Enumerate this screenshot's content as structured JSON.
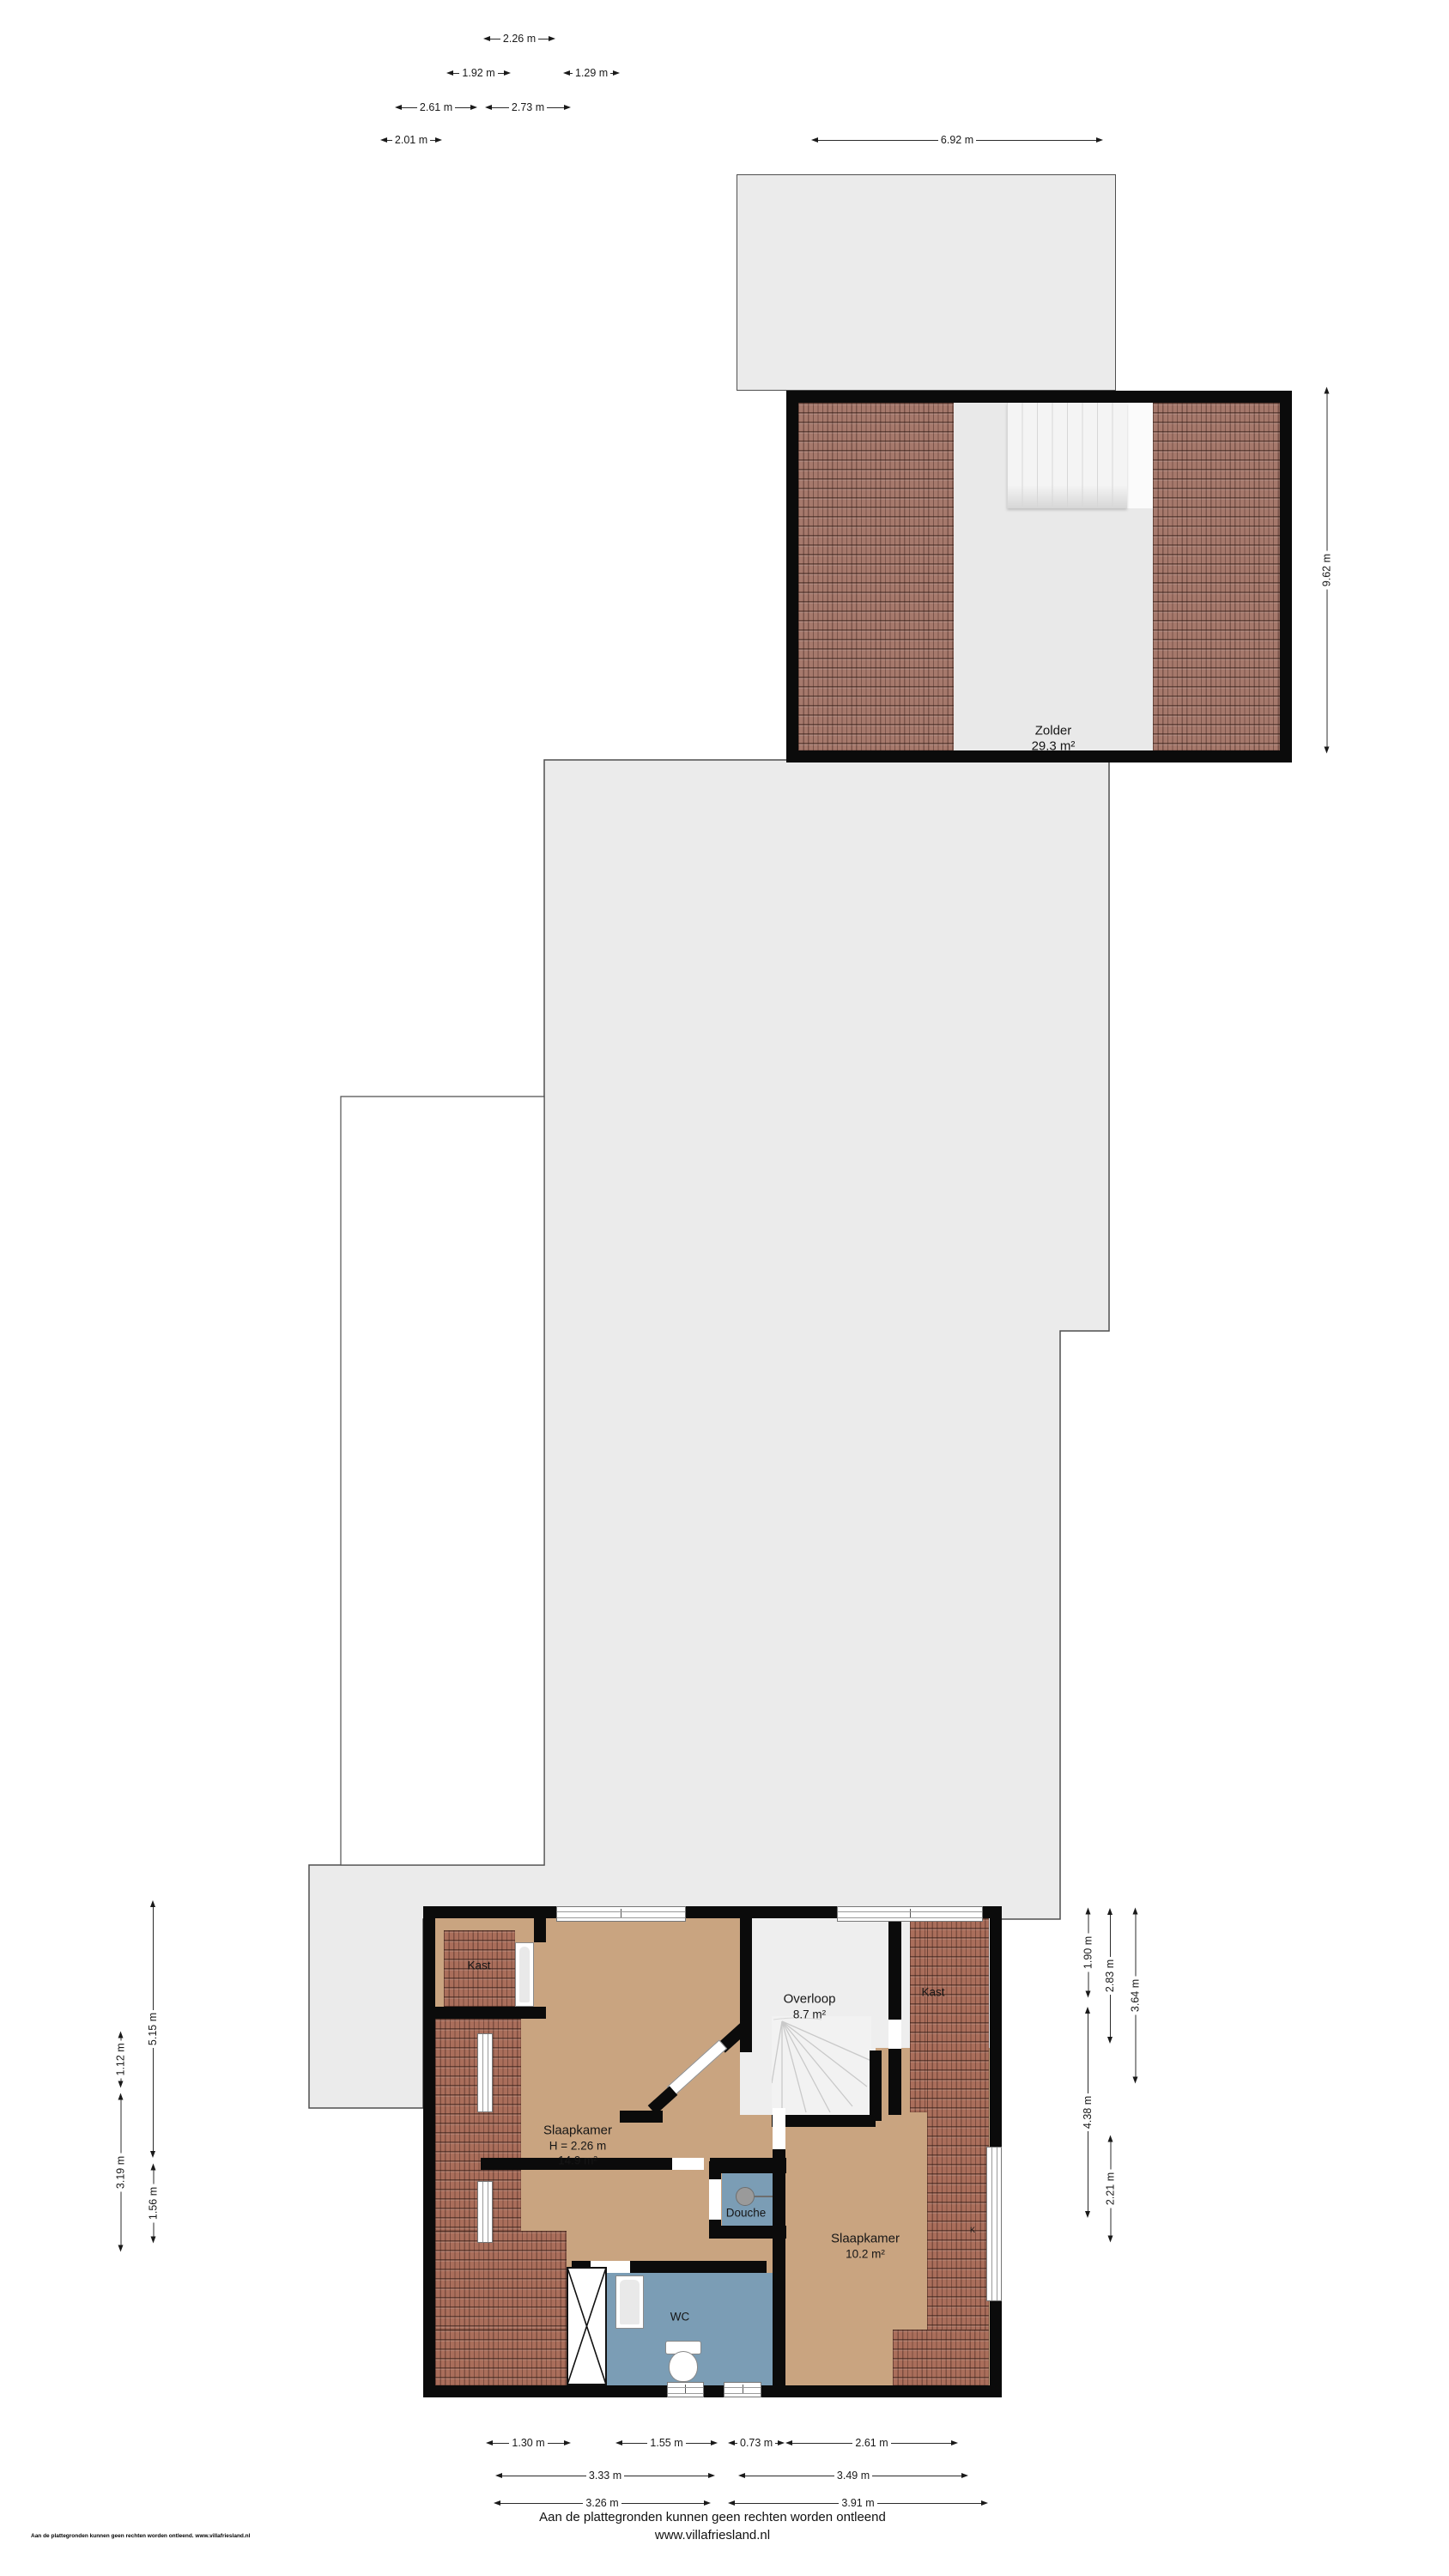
{
  "rooms": {
    "attic": {
      "name": "Zolder",
      "area": "29.3 m²"
    },
    "landing": {
      "name": "Overloop",
      "area": "8.7 m²"
    },
    "bedroom_left": {
      "name": "Slaapkamer",
      "height": "H = 2.26 m",
      "area": "14.9 m²"
    },
    "bedroom_right": {
      "name": "Slaapkamer",
      "area": "10.2 m²"
    },
    "shower": {
      "name": "Douche"
    },
    "wc": {
      "name": "WC"
    },
    "closet_left": {
      "label": "Kast"
    },
    "closet_right": {
      "label": "Kast"
    },
    "closet_abbr": {
      "label": "K"
    }
  },
  "dimensions": {
    "top": [
      "2.26 m",
      "1.92 m",
      "1.29 m",
      "2.61 m",
      "2.73 m",
      "2.01 m",
      "6.92 m"
    ],
    "attic_side": "9.62 m",
    "left": [
      "5.15 m",
      "1.12 m",
      "3.19 m",
      "1.56 m"
    ],
    "right": [
      "1.90 m",
      "2.83 m",
      "3.64 m",
      "4.38 m",
      "2.21 m"
    ],
    "bottom": [
      "1.30 m",
      "1.55 m",
      "0.73 m",
      "2.61 m",
      "3.33 m",
      "3.49 m",
      "3.26 m",
      "3.91 m"
    ]
  },
  "footer": {
    "disclaimer": "Aan de plattegronden kunnen geen rechten worden ontleend",
    "website": "www.villafriesland.nl",
    "corner": "Aan de plattegronden kunnen geen rechten worden ontleend. www.villafriesland.nl"
  },
  "colors": {
    "roof_tile": "#a6796c",
    "floor_tan": "#c9a480",
    "wet_room_blue": "#7b9db5",
    "background_grey": "#ebebeb",
    "wall_black": "#0b0b0b"
  }
}
